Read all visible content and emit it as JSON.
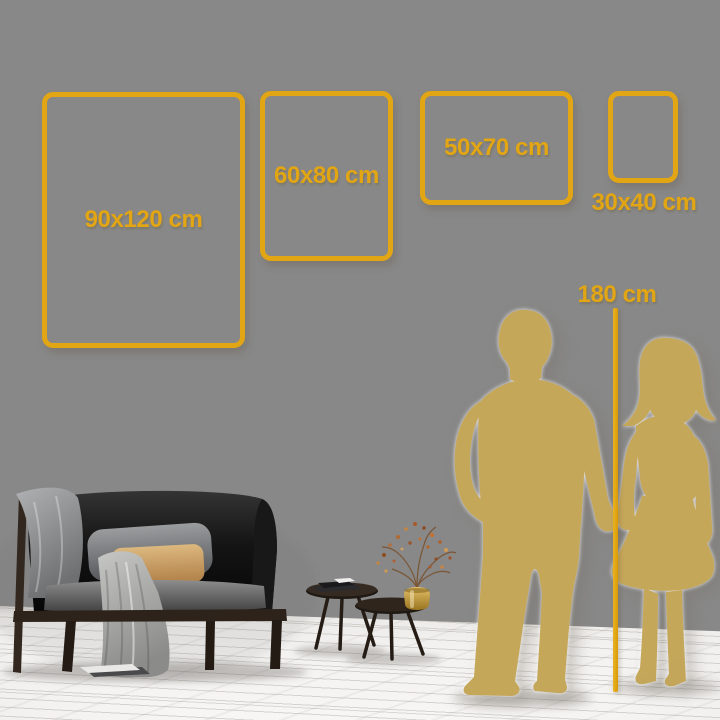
{
  "size_guide": {
    "frames": [
      {
        "label": "90x120 cm"
      },
      {
        "label": "60x80 cm"
      },
      {
        "label": "50x70 cm"
      },
      {
        "label": "30x40 cm"
      }
    ],
    "height_reference": {
      "label": "180 cm"
    }
  },
  "colors": {
    "accent_gold": "#E2A513",
    "silhouette_gold": "#C5A75A",
    "wall": "#E3E0DD",
    "floor": "#F4F3F1"
  },
  "scene": {
    "silhouettes": [
      "man",
      "woman"
    ],
    "furniture": [
      "sofa",
      "throw-blanket",
      "pillows",
      "nesting-coffee-tables",
      "books",
      "gold-vase-with-dried-branches"
    ]
  }
}
